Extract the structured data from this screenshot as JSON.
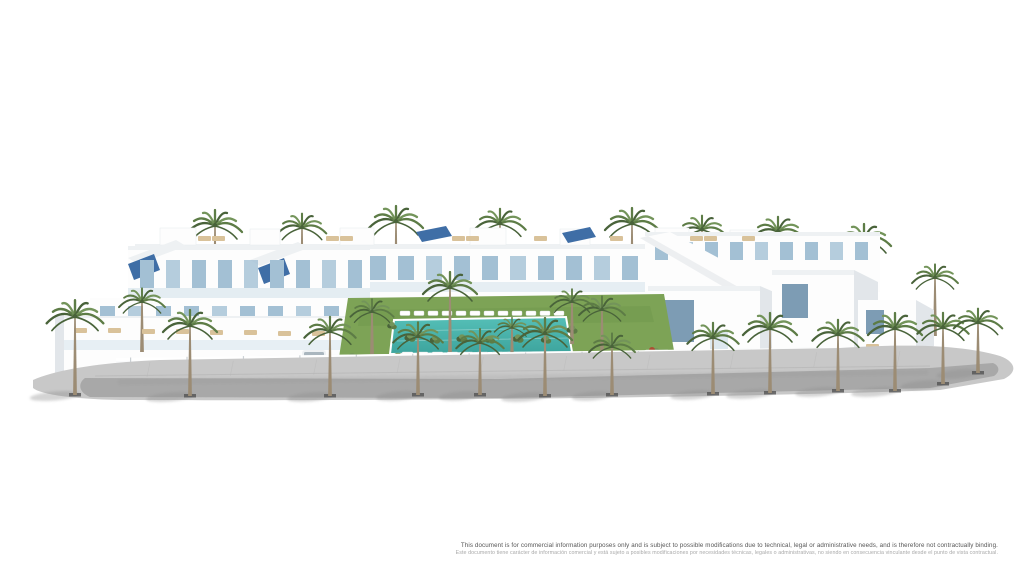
{
  "image": {
    "description": "Aerial 3D architectural rendering of a white Mediterranean residential complex with roof terraces, solar panels, communal lawn, swimming pool with sun loungers, perimeter wall and palm-lined street",
    "background": "#ffffff"
  },
  "disclaimer": {
    "line_en": "This document is for commercial information purposes only and is subject to possible modifications due to technical, legal or administrative needs, and is therefore not contractually binding.",
    "line_es": "Este documento tiene carácter de información comercial y está sujeto a posibles modificaciones por necesidades técnicas, legales o administrativas, no siendo en consecuencia vinculante desde el punto de vista contractual."
  },
  "scene": {
    "palette": {
      "sky": "#ffffff",
      "building_white": "#fdfdfd",
      "building_shade": "#eef1f3",
      "building_shade2": "#e2e6ea",
      "window_blue": "#a3c0d4",
      "window_blue_dark": "#7d9cb4",
      "glass_rail": "#dde8ef",
      "solar_panel": "#3f6ea6",
      "lawn": "#7da356",
      "lawn_dark": "#6a9147",
      "pool_water": "#55bfb7",
      "pool_water_dark": "#3da49d",
      "palm_green_dark": "#49633a",
      "palm_green": "#5d7c46",
      "palm_green_light": "#73945a",
      "palm_trunk": "#9c8c74",
      "road": "#a6a6a6",
      "road_light": "#c8c8c8",
      "shadow": "#8f8f8f",
      "lounger_tan": "#d9c29a",
      "accent_red": "#b0452f",
      "text_dark": "#555555",
      "text_light": "#a9a9a9"
    },
    "palms_back": [
      {
        "x": 215,
        "y": 302,
        "h": 76,
        "s": 1
      },
      {
        "x": 302,
        "y": 298,
        "h": 70,
        "s": 0.9
      },
      {
        "x": 396,
        "y": 300,
        "h": 78,
        "s": 1
      },
      {
        "x": 500,
        "y": 298,
        "h": 74,
        "s": 0.95
      },
      {
        "x": 632,
        "y": 298,
        "h": 74,
        "s": 1
      },
      {
        "x": 702,
        "y": 294,
        "h": 64,
        "s": 0.9
      },
      {
        "x": 778,
        "y": 302,
        "h": 70,
        "s": 0.95
      },
      {
        "x": 864,
        "y": 314,
        "h": 74,
        "s": 1
      },
      {
        "x": 690,
        "y": 318,
        "h": 60,
        "s": 0.85
      },
      {
        "x": 822,
        "y": 334,
        "h": 68,
        "s": 0.9
      },
      {
        "x": 935,
        "y": 336,
        "h": 58,
        "s": 0.85
      }
    ],
    "palms_mid": [
      {
        "x": 142,
        "y": 352,
        "h": 50,
        "s": 0.85
      },
      {
        "x": 372,
        "y": 354,
        "h": 42,
        "s": 0.8
      },
      {
        "x": 450,
        "y": 352,
        "h": 64,
        "s": 1
      },
      {
        "x": 512,
        "y": 358,
        "h": 30,
        "s": 0.65
      },
      {
        "x": 572,
        "y": 344,
        "h": 42,
        "s": 0.8
      },
      {
        "x": 602,
        "y": 356,
        "h": 46,
        "s": 0.85
      }
    ],
    "palms_front": [
      {
        "x": 75,
        "y": 395,
        "h": 78,
        "s": 1.05,
        "grate": true
      },
      {
        "x": 190,
        "y": 396,
        "h": 70,
        "s": 1,
        "grate": true
      },
      {
        "x": 330,
        "y": 396,
        "h": 64,
        "s": 0.95,
        "grate": true
      },
      {
        "x": 418,
        "y": 395,
        "h": 58,
        "s": 0.92,
        "grate": true
      },
      {
        "x": 480,
        "y": 395,
        "h": 52,
        "s": 0.88,
        "grate": true
      },
      {
        "x": 545,
        "y": 396,
        "h": 62,
        "s": 1,
        "grate": true
      },
      {
        "x": 612,
        "y": 395,
        "h": 48,
        "s": 0.85,
        "grate": true
      },
      {
        "x": 713,
        "y": 394,
        "h": 56,
        "s": 0.95,
        "grate": true
      },
      {
        "x": 770,
        "y": 393,
        "h": 64,
        "s": 1,
        "grate": true
      },
      {
        "x": 838,
        "y": 391,
        "h": 56,
        "s": 0.95,
        "grate": true
      },
      {
        "x": 895,
        "y": 391,
        "h": 62,
        "s": 1,
        "grate": true
      },
      {
        "x": 943,
        "y": 384,
        "h": 56,
        "s": 0.95,
        "grate": true
      },
      {
        "x": 978,
        "y": 373,
        "h": 50,
        "s": 0.9,
        "grate": true
      }
    ],
    "windows": {
      "rear_row": {
        "x0": 146,
        "y": 256,
        "step": 28,
        "count": 22,
        "w": 16,
        "h": 24,
        "cls": "winblue"
      },
      "left_upper": {
        "x0": 140,
        "y": 260,
        "step": 26,
        "count": 9,
        "w": 14,
        "h": 28,
        "cls": "winblue"
      },
      "left_mid": {
        "x0": 100,
        "y": 306,
        "step": 28,
        "count": 10,
        "w": 15,
        "h": 26,
        "cls": "winblue"
      },
      "right_rear": {
        "x0": 655,
        "y": 242,
        "step": 25,
        "count": 9,
        "w": 13,
        "h": 18,
        "cls": "winblue"
      }
    },
    "pool_loungers": [
      {
        "x0": 400,
        "y": 311,
        "step": 14,
        "count": 12,
        "w": 10,
        "h": 4.5,
        "fill": "#ffffff"
      },
      {
        "x0": 402,
        "y": 352,
        "step": 15,
        "count": 11,
        "w": 11,
        "h": 5,
        "fill": "#ffffff"
      }
    ],
    "tan_loungers": [
      [
        74,
        328
      ],
      [
        108,
        328
      ],
      [
        142,
        329
      ],
      [
        176,
        329
      ],
      [
        210,
        330
      ],
      [
        244,
        330
      ],
      [
        278,
        331
      ],
      [
        312,
        331
      ],
      [
        198,
        236
      ],
      [
        212,
        236
      ],
      [
        326,
        236
      ],
      [
        340,
        236
      ],
      [
        452,
        236
      ],
      [
        466,
        236
      ],
      [
        534,
        236
      ],
      [
        610,
        236
      ],
      [
        690,
        236
      ],
      [
        704,
        236
      ],
      [
        742,
        236
      ],
      [
        718,
        360
      ],
      [
        736,
        361
      ],
      [
        800,
        350
      ],
      [
        816,
        351
      ],
      [
        866,
        344
      ]
    ],
    "bushes": [
      {
        "x": 352,
        "y": 360,
        "s": 1
      },
      {
        "x": 374,
        "y": 363,
        "s": 0.9
      },
      {
        "x": 398,
        "y": 360,
        "s": 1.1
      },
      {
        "x": 424,
        "y": 362,
        "s": 0.9
      },
      {
        "x": 448,
        "y": 361,
        "s": 1
      },
      {
        "x": 472,
        "y": 363,
        "s": 1.1
      },
      {
        "x": 498,
        "y": 360,
        "s": 0.9
      },
      {
        "x": 524,
        "y": 362,
        "s": 1
      },
      {
        "x": 548,
        "y": 361,
        "s": 1.1
      },
      {
        "x": 576,
        "y": 362,
        "s": 0.9
      },
      {
        "x": 604,
        "y": 360,
        "s": 1
      },
      {
        "x": 632,
        "y": 358,
        "s": 0.95
      },
      {
        "x": 656,
        "y": 354,
        "s": 0.9
      },
      {
        "x": 410,
        "y": 338,
        "s": 0.7
      },
      {
        "x": 435,
        "y": 340,
        "s": 0.65
      },
      {
        "x": 462,
        "y": 339,
        "s": 0.7
      },
      {
        "x": 490,
        "y": 340,
        "s": 0.65
      },
      {
        "x": 518,
        "y": 339,
        "s": 0.7
      },
      {
        "x": 546,
        "y": 340,
        "s": 0.65
      },
      {
        "x": 392,
        "y": 326,
        "s": 0.6
      },
      {
        "x": 572,
        "y": 330,
        "s": 0.7
      }
    ],
    "red_shrubs": [
      {
        "x": 386,
        "y": 360
      },
      {
        "x": 548,
        "y": 363
      },
      {
        "x": 652,
        "y": 350
      }
    ],
    "wall_posts": {
      "x0": 130,
      "x1": 920,
      "count": 15,
      "ytop0": 357.5,
      "ytop1": 347.5,
      "h": 21
    },
    "sidewalk_joints": {
      "x0": 150,
      "x1": 900,
      "count": 10,
      "y0": 362,
      "y1": 351,
      "len": 15
    }
  }
}
